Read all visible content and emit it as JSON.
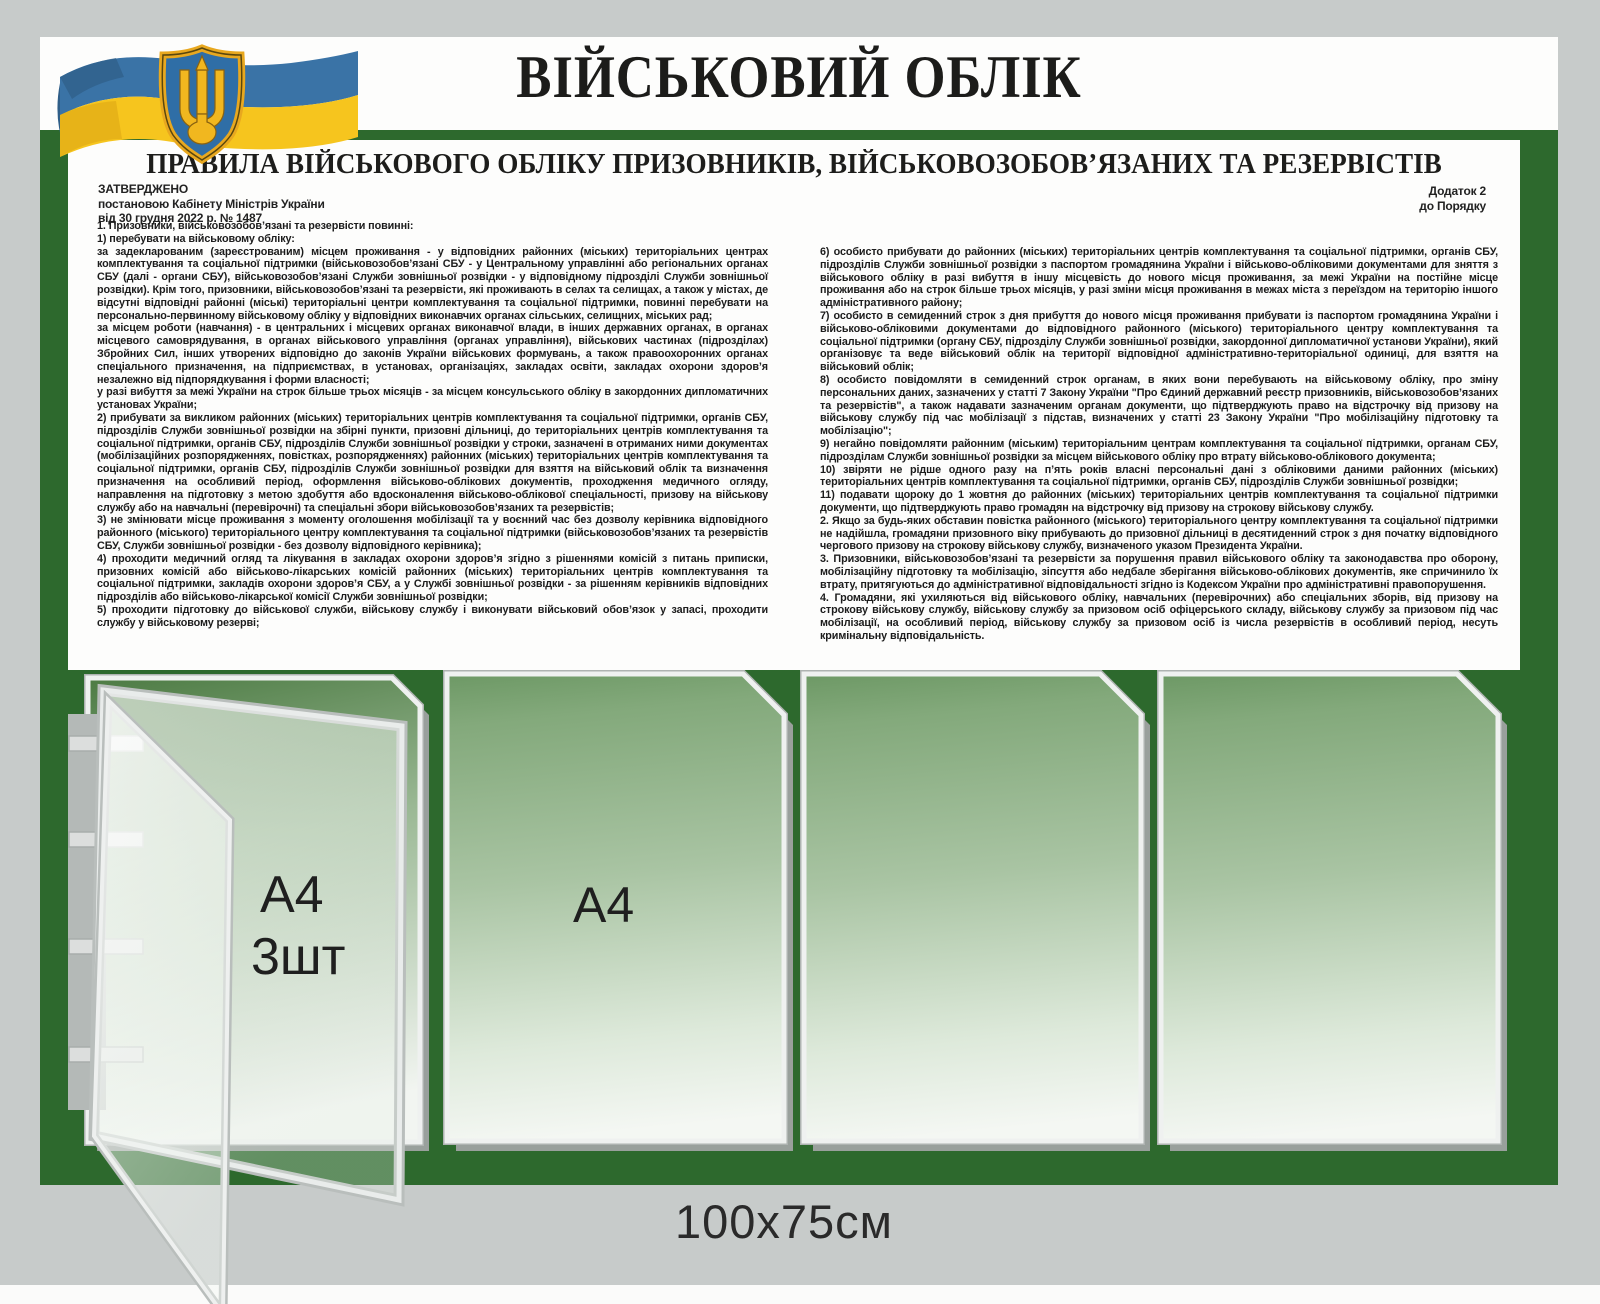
{
  "board": {
    "title": "ВІЙСЬКОВИЙ ОБЛІК",
    "size_label": "100x75см",
    "colors": {
      "board_green": "#2d692d",
      "background_gray": "#c7cbca",
      "flag_blue": "#3a73a6",
      "flag_yellow": "#f6c51e",
      "emblem_gold": "#e8a81f",
      "emblem_blue": "#2f6ea6"
    },
    "icons": {
      "flag": "ukraine-waving-flag",
      "emblem": "ukraine-tryzub-coat-of-arms"
    }
  },
  "doc": {
    "title": "ПРАВИЛА ВІЙСЬКОВОГО ОБЛІКУ ПРИЗОВНИКІВ, ВІЙСЬКОВОЗОБОВ’ЯЗАНИХ ТА РЕЗЕРВІСТІВ",
    "approval": {
      "line1": "ЗАТВЕРДЖЕНО",
      "line2": "постановою Кабінету Міністрів України",
      "line3": "від 30 грудня 2022 р. № 1487"
    },
    "annex": {
      "line1": "Додаток 2",
      "line2": "до Порядку"
    },
    "left": [
      "1. Призовники, військовозобов’язані та резервісти повинні:",
      "1) перебувати на військовому обліку:",
      "за задекларованим (зареєстрованим) місцем проживання - у відповідних районних (міських) територіальних центрах комплектування та соціальної підтримки (військовозобов’язані СБУ - у Центральному управлінні або регіональних органах СБУ (далі - органи СБУ), військовозобов’язані Служби зовнішньої розвідки - у відповідному підрозділі Служби зовнішньої розвідки). Крім того, призовники, військовозобов’язані та резервісти, які проживають в селах та селищах, а також у містах, де відсутні відповідні районні (міські) територіальні центри комплектування та соціальної підтримки, повинні перебувати на персонально-первинному військовому обліку у відповідних виконавчих органах сільських, селищних, міських рад;",
      "за місцем роботи (навчання) - в центральних і місцевих органах виконавчої влади, в інших державних органах, в органах місцевого самоврядування, в органах військового управління (органах управління), військових частинах (підрозділах) Збройних Сил, інших утворених відповідно до законів України військових формувань, а також правоохоронних органах спеціального призначення, на підприємствах, в установах, організаціях, закладах освіти, закладах охорони здоров’я незалежно від підпорядкування і форми власності;",
      "у разі вибуття за межі України на строк більше трьох місяців - за місцем консульського обліку в закордонних дипломатичних установах України;",
      "2) прибувати за викликом районних (міських) територіальних центрів комплектування та соціальної підтримки, органів СБУ, підрозділів Служби зовнішньої розвідки на збірні пункти, призовні дільниці, до територіальних центрів комплектування та соціальної підтримки, органів СБУ, підрозділів Служби зовнішньої розвідки у строки, зазначені в отриманих ними документах (мобілізаційних розпорядженнях, повістках, розпорядженнях) районних (міських) територіальних центрів комплектування та соціальної підтримки, органів СБУ, підрозділів Служби зовнішньої розвідки для взяття на військовий облік та визначення призначення на особливий період, оформлення військово-облікових документів, проходження медичного огляду, направлення на підготовку з метою здобуття або вдосконалення військово-облікової спеціальності, призову на військову службу або на навчальні (перевірочні) та спеціальні збори військовозобов’язаних та резервістів;",
      "3) не змінювати місце проживання з моменту оголошення мобілізації та у воєнний час без дозволу керівника відповідного районного (міського) територіального центру комплектування та соціальної підтримки (військовозобов’язаних та резервістів СБУ, Служби зовнішньої розвідки - без дозволу відповідного керівника);",
      "4) проходити медичний огляд та лікування в закладах охорони здоров’я згідно з рішеннями комісій з питань приписки, призовних комісій або військово-лікарських комісій районних (міських) територіальних центрів комплектування та соціальної підтримки, закладів охорони здоров’я СБУ, а у Службі зовнішньої розвідки - за рішенням керівників відповідних підрозділів або військово-лікарської комісії Служби зовнішньої розвідки;",
      "5) проходити підготовку до військової служби, військову службу і виконувати військовий обов’язок у запасі, проходити службу у військовому резерві;"
    ],
    "right": [
      "6) особисто прибувати до районних (міських) територіальних центрів комплектування та соціальної підтримки, органів СБУ, підрозділів Служби зовнішньої розвідки з паспортом громадянина України і військово-обліковими документами для зняття з військового обліку в разі вибуття в іншу місцевість до нового місця проживання, за межі України на постійне місце проживання або на строк більше трьох місяців, у разі зміни місця проживання в межах міста з переїздом на територію іншого адміністративного району;",
      "7) особисто в семиденний строк з дня прибуття до нового місця проживання прибувати із паспортом громадянина України і військово-обліковими документами до відповідного районного (міського) територіального центру комплектування та соціальної підтримки (органу СБУ, підрозділу Служби зовнішньої розвідки, закордонної дипломатичної установи України), який організовує та веде військовий облік на території відповідної адміністративно-територіальної одиниці, для взяття на військовий облік;",
      "8) особисто повідомляти в семиденний строк органам, в яких вони перебувають на військовому обліку, про зміну персональних даних, зазначених у статті 7 Закону України \"Про Єдиний державний реєстр призовників, військовозобов’язаних та резервістів\", а також надавати зазначеним органам документи, що підтверджують право на відстрочку від призову на військову службу під час мобілізації з підстав, визначених у статті 23 Закону України \"Про мобілізаційну підготовку та мобілізацію\";",
      "9) негайно повідомляти районним (міським) територіальним центрам комплектування та соціальної підтримки, органам СБУ, підрозділам Служби зовнішньої розвідки за місцем військового обліку про втрату військово-облікового документа;",
      "10) звіряти не рідше одного разу на п’ять років власні персональні дані з обліковими даними районних (міських) територіальних центрів комплектування та соціальної підтримки, органів СБУ, підрозділів Служби зовнішньої розвідки;",
      "11) подавати щороку до 1 жовтня до районних (міських) територіальних центрів комплектування та соціальної підтримки документи, що підтверджують право громадян на відстрочку від призову на строкову військову службу.",
      "2. Якщо за будь-яких обставин повістка районного (міського) територіального центру комплектування та соціальної підтримки не надійшла, громадяни призовного віку прибувають до призовної дільниці в десятиденний строк з дня початку відповідного чергового призову на строкову військову службу, визначеного указом Президента України.",
      "3. Призовники, військовозобов’язані та резервісти за порушення правил військового обліку та законодавства про оборону, мобілізаційну підготовку та мобілізацію, зіпсуття або недбале зберігання військово-облікових документів, яке спричинило їх втрату, притягуються до адміністративної відповідальності згідно із Кодексом України про адміністративні правопорушення.",
      "4. Громадяни, які ухиляються від військового обліку, навчальних (перевірочних) або спеціальних зборів, від призову на строкову військову службу, військову службу за призовом осіб офіцерського складу, військову службу за призовом під час мобілізації, на особливий період, військову службу за призовом осіб із числа резервістів в особливий період, несуть кримінальну відповідальність."
    ]
  },
  "pockets": {
    "open_label_line1": "A4",
    "open_label_line2": "3шт",
    "flat_label": "A4"
  }
}
